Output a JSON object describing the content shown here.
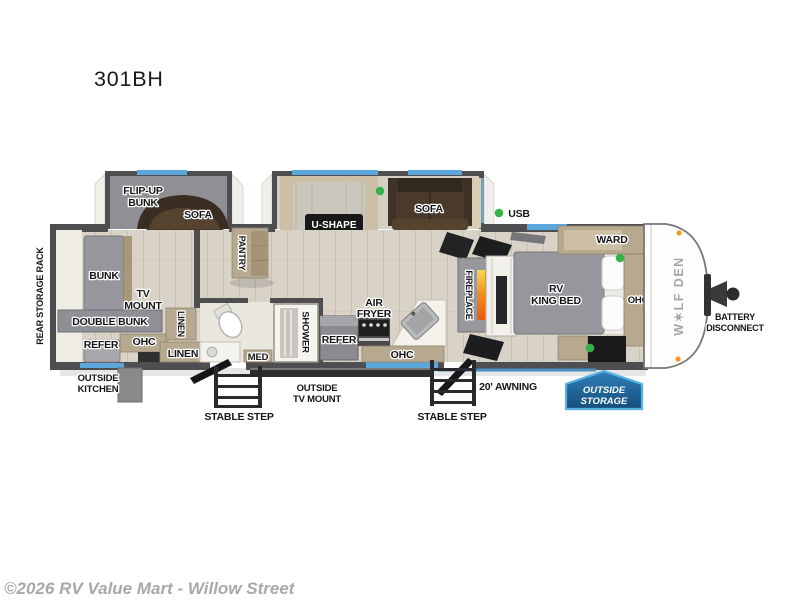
{
  "title": "301BH",
  "copyright": "©2026 RV Value Mart - Willow Street",
  "brand": "W✶LF DEN",
  "colors": {
    "window": "#5ba7db",
    "usb_dot": "#33b24a",
    "marker_light": "#f59a23",
    "awning": "#4a90c4",
    "badge_border": "#57b2e2"
  },
  "labels": {
    "rear_storage_rack": "REAR STORAGE RACK",
    "flip_up_bunk": [
      "FLIP-UP",
      "BUNK"
    ],
    "sofa_rear": "SOFA",
    "bunk": "BUNK",
    "tv_mount": [
      "TV",
      "MOUNT"
    ],
    "double_bunk": "DOUBLE BUNK",
    "refer_rear": "REFER",
    "ohc_rear": "OHC",
    "linen_closet": "LINEN",
    "linen_cabinet": "LINEN",
    "pantry": "PANTRY",
    "dinette": [
      "U-SHAPE",
      "DINETTE"
    ],
    "sofa_main": "SOFA",
    "usb": "USB",
    "med": "MED",
    "shower": "SHOWER",
    "refer_kitchen": "REFER",
    "air_fryer": [
      "AIR",
      "FRYER"
    ],
    "ohc_kitchen": "OHC",
    "fireplace": "FIREPLACE",
    "king_bed": [
      "RV",
      "KING BED"
    ],
    "ward": "WARD",
    "ohc_bedroom": "OHC",
    "battery_disconnect": [
      "BATTERY",
      "DISCONNECT"
    ],
    "outside_kitchen": [
      "OUTSIDE",
      "KITCHEN"
    ],
    "outside_tv_mount": [
      "OUTSIDE",
      "TV MOUNT"
    ],
    "stable_step_left": "STABLE STEP",
    "stable_step_right": "STABLE STEP",
    "awning": "20' AWNING",
    "outside_storage": [
      "OUTSIDE",
      "STORAGE"
    ]
  }
}
